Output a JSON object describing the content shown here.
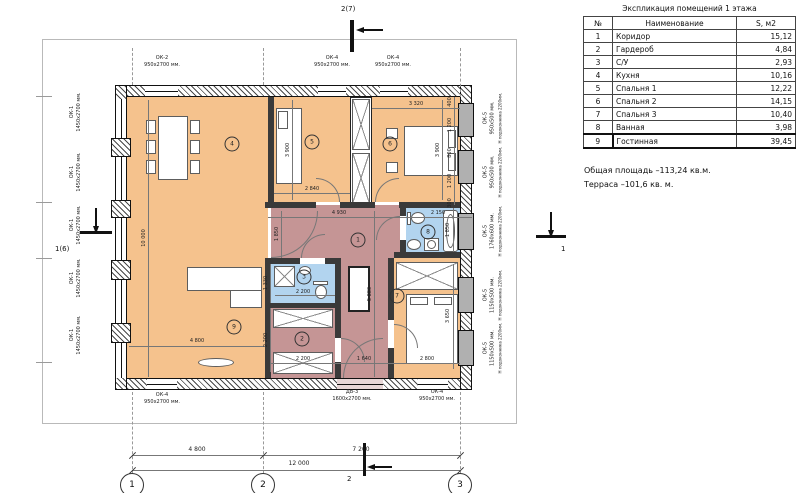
{
  "legend": {
    "title": "Экспликация помещений 1 этажа",
    "col_num": "№",
    "col_name": "Наименование",
    "col_area": "S, м2",
    "rows": [
      {
        "num": "1",
        "name": "Коридор",
        "area": "15,12"
      },
      {
        "num": "2",
        "name": "Гардероб",
        "area": "4,84"
      },
      {
        "num": "3",
        "name": "С/У",
        "area": "2,93"
      },
      {
        "num": "4",
        "name": "Кухня",
        "area": "10,16"
      },
      {
        "num": "5",
        "name": "Спальня 1",
        "area": "12,22"
      },
      {
        "num": "6",
        "name": "Спальня 2",
        "area": "14,15"
      },
      {
        "num": "7",
        "name": "Спальня 3",
        "area": "10,40"
      },
      {
        "num": "8",
        "name": "Ванная",
        "area": "3,98"
      },
      {
        "num": "9",
        "name": "Гостинная",
        "area": "39,45"
      }
    ],
    "note_total": "Общая площадь –113,24 кв.м.",
    "note_terrace": "Терраса –101,6 кв. м."
  },
  "markers": {
    "top": "2(7)",
    "left": "1(6)",
    "right": "1",
    "bottom": "2"
  },
  "axes": {
    "labels": [
      "1",
      "2",
      "3"
    ],
    "dim_12": "4 800",
    "dim_23": "7 200",
    "dim_total": "12 000"
  },
  "openings": {
    "top": [
      {
        "code": "ОК-2",
        "size": "950х2700 мм."
      },
      {
        "code": "ОК-4",
        "size": "950х2700 мм."
      },
      {
        "code": "ОК-4",
        "size": "950х2700 мм."
      }
    ],
    "bottom": [
      {
        "code": "ОК-4",
        "size": "950х2700 мм."
      },
      {
        "code": "ДВ-3",
        "size": "1600х2700 мм."
      },
      {
        "code": "ОК-4",
        "size": "950х2700 мм."
      }
    ],
    "left": {
      "code": "ОК-1",
      "size": "1450х2700 мм."
    },
    "right": [
      {
        "code": "ОК-5",
        "size": "950х500 мм.",
        "sill": "H подоконника 2200мм."
      },
      {
        "code": "ОК-5",
        "size": "950х500 мм.",
        "sill": "H подоконника 2200мм."
      },
      {
        "code": "ОК-5",
        "size": "1760х600 мм.",
        "sill": "H подоконника 2200мм."
      },
      {
        "code": "ОК-5",
        "size": "1150х500 мм.",
        "sill": "H подоконника 2200мм."
      },
      {
        "code": "ОК-5",
        "size": "1150х500 мм.",
        "sill": "H подоконника 2200мм."
      }
    ]
  },
  "room_badges": [
    "1",
    "2",
    "3",
    "4",
    "5",
    "6",
    "7",
    "8",
    "9"
  ],
  "dims": {
    "living_height": "10 000",
    "living_width": "4 800",
    "bedroom1_height": "3 900",
    "bedroom1_width": "2 840",
    "bedroom2_width": "3 320",
    "bedroom2_height": "3 900",
    "window_stack": [
      "400",
      "1 200",
      "800",
      "1 200",
      "300"
    ],
    "corridor_width": "4 930",
    "corridor_opening": "1 850",
    "corridor_height": "5 880",
    "corridor_bottom": "1 640",
    "bathroom_width": "2 150",
    "bathroom_height": "1 850",
    "wc_height": "1 330",
    "wc_width": "2 200",
    "wardrobe_height": "2 200",
    "wardrobe_width": "2 200",
    "bedroom3_height": "3 650",
    "bedroom3_width": "2 800"
  }
}
